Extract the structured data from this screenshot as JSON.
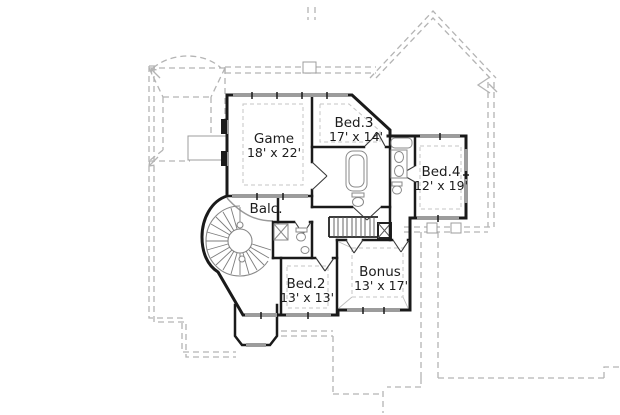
{
  "plan": {
    "type": "second-floor-plan",
    "rooms": [
      {
        "id": "game",
        "name": "Game",
        "dims": "18' x 22'"
      },
      {
        "id": "bed3",
        "name": "Bed.3",
        "dims": "17' x 14'"
      },
      {
        "id": "bed4",
        "name": "Bed.4",
        "dims": "12' x 19'"
      },
      {
        "id": "balc",
        "name": "Balc.",
        "dims": ""
      },
      {
        "id": "bed2",
        "name": "Bed.2",
        "dims": "13' x 13'"
      },
      {
        "id": "bonus",
        "name": "Bonus",
        "dims": "13' x 17'"
      }
    ],
    "features": [
      "spiral-staircase",
      "straight-staircase",
      "two-bathrooms",
      "balcony",
      "porch-bay"
    ],
    "colors": {
      "background": "#ffffff",
      "wall": "#1a1a1a",
      "window": "#9c9c9c",
      "fixture": "#8a8a8a",
      "roof_dash": "#b4b4b4",
      "ceiling_dash": "#c5c5c5",
      "text": "#1c1c1c"
    }
  }
}
